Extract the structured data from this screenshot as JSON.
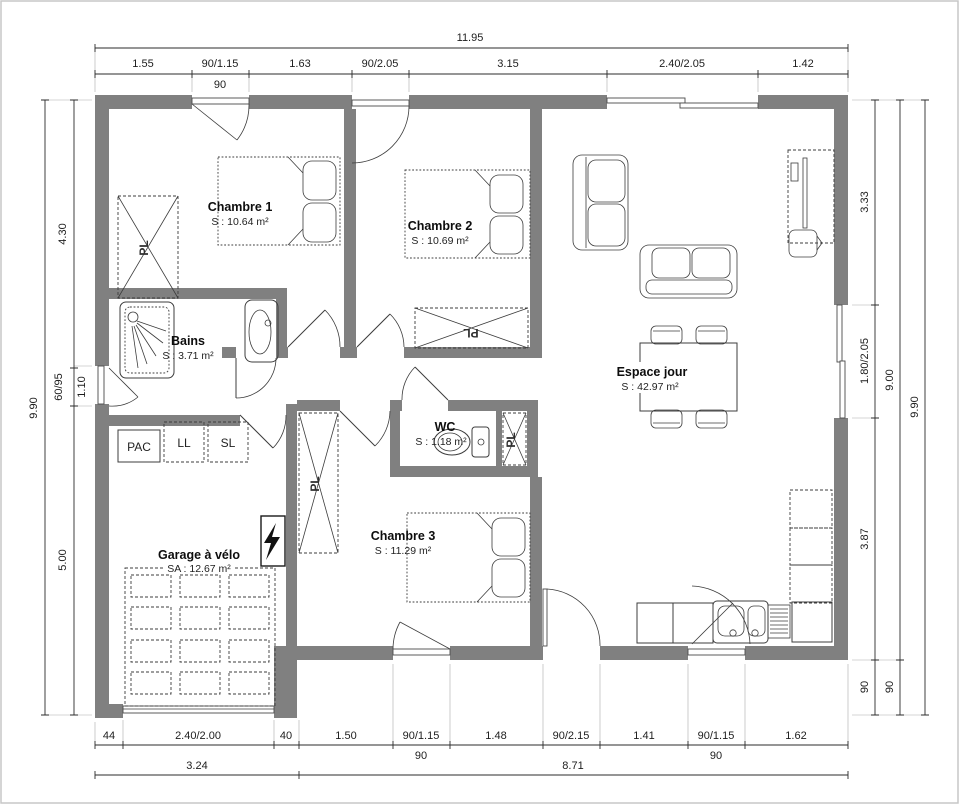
{
  "plan_title": "floor-plan",
  "colors": {
    "wall": "#808080",
    "line": "#3c3c3c",
    "dimension_text": "#1d1d1d",
    "background": "#ffffff"
  },
  "rooms": {
    "chambre1": {
      "name": "Chambre 1",
      "area": "S : 10.64 m²"
    },
    "chambre2": {
      "name": "Chambre 2",
      "area": "S : 10.69 m²"
    },
    "chambre3": {
      "name": "Chambre 3",
      "area": "S : 11.29 m²"
    },
    "bains": {
      "name": "Bains",
      "area": "S : 3.71 m²"
    },
    "wc": {
      "name": "WC",
      "area": "S : 1.18 m²"
    },
    "espace_jour": {
      "name": "Espace jour",
      "area": "S : 42.97 m²"
    },
    "garage": {
      "name": "Garage à vélo",
      "area": "SA : 12.67 m²"
    }
  },
  "equipment": {
    "pac": "PAC",
    "ll": "LL",
    "sl": "SL",
    "pl": "PL"
  },
  "dimensions": {
    "top": {
      "total": "11.95",
      "segments": [
        "1.55",
        "90/1.15",
        "1.63",
        "90/2.05",
        "3.15",
        "2.40/2.05",
        "1.42"
      ],
      "sub": "90"
    },
    "left": {
      "total": "9.90",
      "segments": [
        "4.30",
        "60/95",
        "5.00"
      ],
      "extra": "1.10"
    },
    "right": {
      "inner": [
        "3.33",
        "1.80/2.05",
        "3.87",
        "90"
      ],
      "middle": [
        "9.00",
        "90"
      ],
      "outer": "9.90"
    },
    "bottom": {
      "row1": [
        "44",
        "2.40/2.00",
        "40",
        "1.50",
        "90/1.15",
        "1.48",
        "90/2.15",
        "1.41",
        "90/1.15",
        "1.62"
      ],
      "sub1": "90",
      "sub2": "90",
      "row2": [
        "3.24",
        "8.71"
      ]
    }
  }
}
